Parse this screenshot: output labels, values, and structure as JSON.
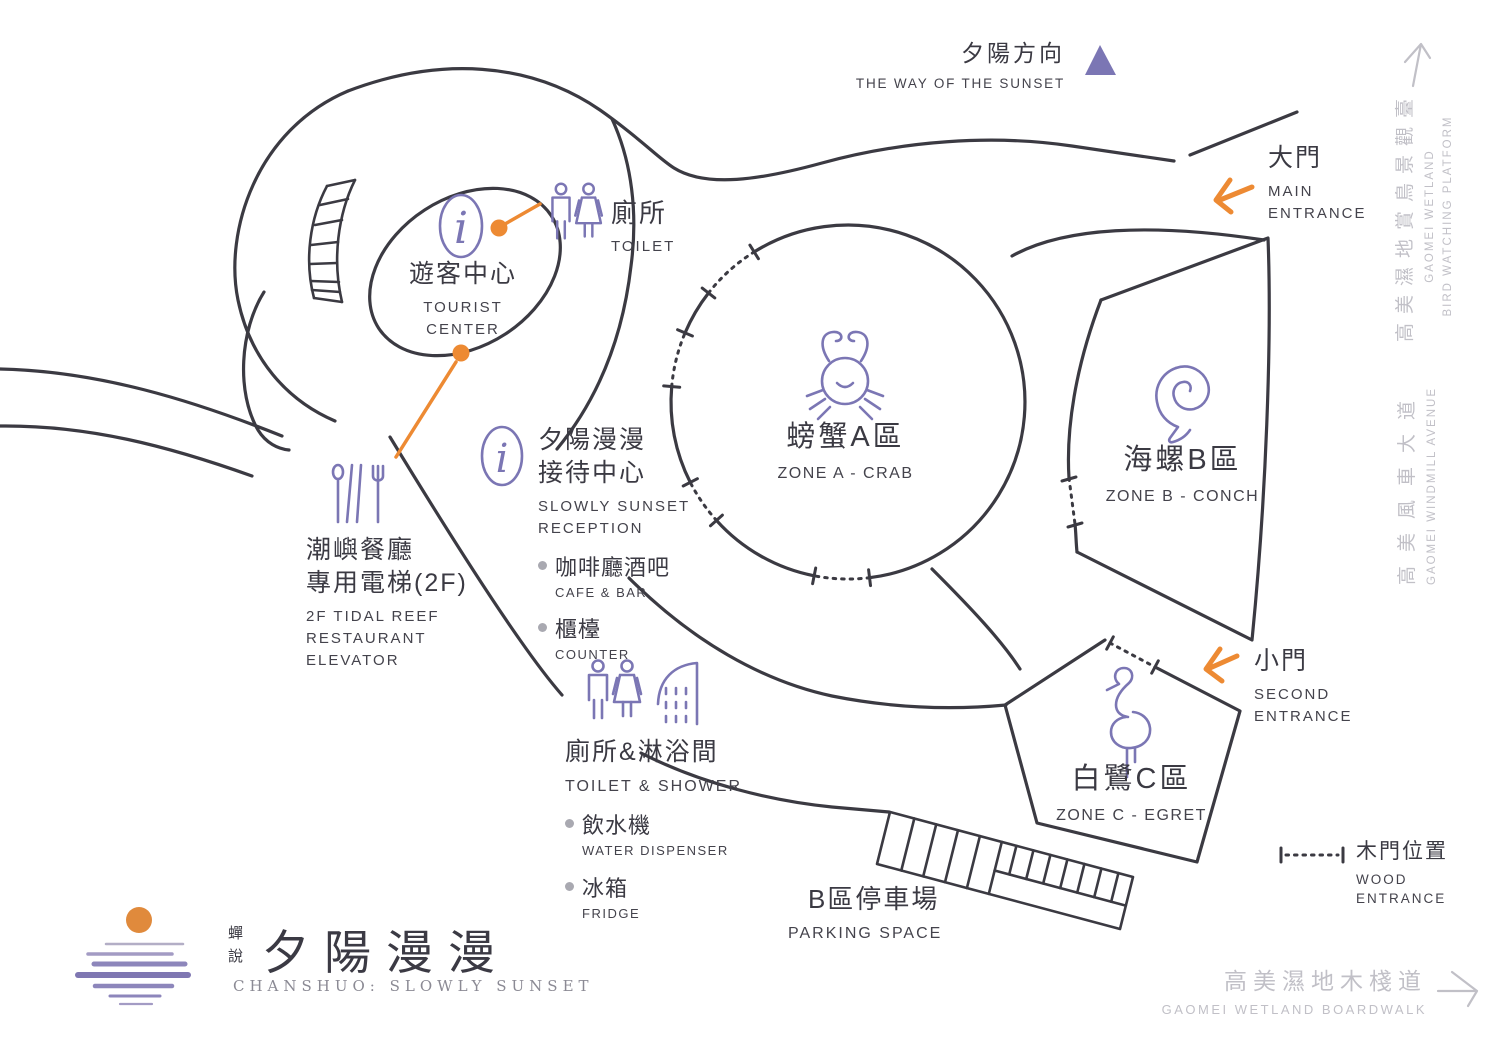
{
  "sunset": {
    "zh": "夕陽方向",
    "en": "THE WAY OF THE SUNSET"
  },
  "entrances": {
    "main": {
      "zh": "大門",
      "en": "MAIN\nENTRANCE"
    },
    "second": {
      "zh": "小門",
      "en": "SECOND\nENTRANCE"
    },
    "wood": {
      "zh": "木門位置",
      "en": "WOOD\nENTRANCE"
    }
  },
  "zones": {
    "a": {
      "zh": "螃蟹A區",
      "en": "ZONE A - CRAB"
    },
    "b": {
      "zh": "海螺B區",
      "en": "ZONE B - CONCH"
    },
    "c": {
      "zh": "白鷺C區",
      "en": "ZONE C - EGRET"
    }
  },
  "facilities": {
    "tourist_center": {
      "zh": "遊客中心",
      "en": "TOURIST\nCENTER"
    },
    "toilet": {
      "zh": "廁所",
      "en": "TOILET"
    },
    "reception": {
      "zh": "夕陽漫漫\n接待中心",
      "en": "SLOWLY SUNSET\nRECEPTION",
      "items": [
        {
          "zh": "咖啡廳酒吧",
          "en": "CAFE & BAR"
        },
        {
          "zh": "櫃檯",
          "en": "COUNTER"
        }
      ]
    },
    "elevator": {
      "zh": "潮嶼餐廳\n專用電梯(2F)",
      "en": "2F TIDAL REEF\nRESTAURANT\nELEVATOR"
    },
    "toilet_shower": {
      "zh": "廁所&淋浴間",
      "en": "TOILET & SHOWER",
      "items": [
        {
          "zh": "飲水機",
          "en": "WATER DISPENSER"
        },
        {
          "zh": "冰箱",
          "en": "FRIDGE"
        }
      ]
    },
    "parking": {
      "zh": "B區停車場",
      "en": "PARKING SPACE"
    }
  },
  "surroundings": {
    "bird_platform": {
      "zh": "高美濕地賞鳥景觀臺",
      "en": "GAOMEI WETLAND\nBIRD WATCHING PLATFORM"
    },
    "windmill": {
      "zh": "高美風車大道",
      "en": "GAOMEI WINDMILL AVENUE"
    },
    "boardwalk": {
      "zh": "高美濕地木棧道",
      "en": "GAOMEI WETLAND BOARDWALK"
    }
  },
  "logo": {
    "brand": "蟬說",
    "title": "夕陽漫漫",
    "subtitle": "CHANSHUO: SLOWLY SUNSET"
  },
  "icons": {
    "sunset_direction": "triangle-up",
    "tourist_center": "info-i",
    "reception": "info-i",
    "toilet": "man-woman-figures",
    "toilet_shower": "man-woman-shower",
    "elevator": "cutlery",
    "zone_a": "crab",
    "zone_b": "conch-shell",
    "zone_c": "egret",
    "bird_platform": "arrow-up",
    "boardwalk": "arrow-right",
    "main_entrance": "orange-arrow",
    "second_entrance": "orange-arrow",
    "logo": "sun-over-water"
  },
  "colors": {
    "line": "#3b3a42",
    "purple": "#7b76b4",
    "orange": "#ed8a33",
    "muted_gray": "#c1c0c7",
    "bullet": "#a9a9b1"
  }
}
